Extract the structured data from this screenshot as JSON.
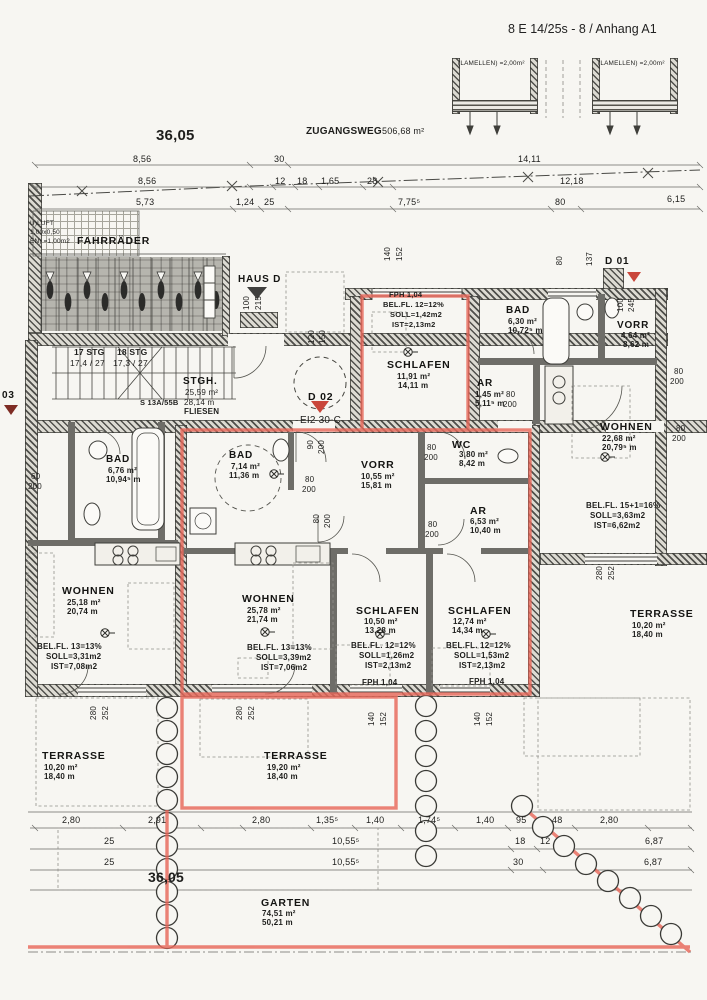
{
  "header": {
    "ref": "8 E 14/25s - 8 / Anhang A1"
  },
  "site": {
    "boundary_total_top": "36,05",
    "boundary_total_bottom": "36,05",
    "zugangsweg": "ZUGANGSWEG",
    "zugangsweg_area": "506,68 m²",
    "lamellen": "(LAMELLEN) =2,00m²",
    "luft1": "U)LUFT",
    "luft2": "1,00x0,50",
    "luft3": "EN) =1,00m2",
    "fahrraeder": "FAHRRÄDER",
    "haus_d": "HAUS D"
  },
  "stairwell": {
    "stg1": "17 STG",
    "stg1_rate": "17,4 / 27",
    "stg2": "18 STG",
    "stg2_rate": "17,3 / 27",
    "name": "STGH.",
    "area": "25,59 m²",
    "perimeter": "28,14 m",
    "floor": "FLIESEN",
    "section": "S 13A/55B"
  },
  "doors": {
    "d01": "D 01",
    "d02": "D 02",
    "d03": "03",
    "d02_class": "EI2 30-C"
  },
  "rooms": {
    "schlafen_top": {
      "name": "SCHLAFEN",
      "area": "11,91 m²",
      "perimeter": "14,11 m",
      "fph": "FPH 1,04",
      "bel": "BEL.FL. 12=12%",
      "soll": "SOLL=1,42m2",
      "ist": "IST=2,13m2"
    },
    "bad_right": {
      "name": "BAD",
      "area": "6,30 m²",
      "perimeter": "10,72⁵ m"
    },
    "vorr_right": {
      "name": "VORR",
      "area": "4,64 m²",
      "perimeter": "8,62 m"
    },
    "ar_small": {
      "name": "AR",
      "area": "1,45 m²",
      "perimeter": "5,11⁵ m"
    },
    "wohnen_right": {
      "name": "WOHNEN",
      "area": "22,68 m²",
      "perimeter": "20,79⁵ m",
      "bel": "BEL.FL. 15+1=16%",
      "soll": "SOLL=3,63m2",
      "ist": "IST=6,62m2"
    },
    "bad_left": {
      "name": "BAD",
      "area": "6,76 m²",
      "perimeter": "10,94⁵ m"
    },
    "wohnen_left": {
      "name": "WOHNEN",
      "area": "25,18 m²",
      "perimeter": "20,74 m",
      "bel": "BEL.FL. 13=13%",
      "soll": "SOLL=3,31m2",
      "ist": "IST=7,08m2"
    },
    "bad_mid": {
      "name": "BAD",
      "area": "7,14 m²",
      "perimeter": "11,36 m"
    },
    "vorr_mid": {
      "name": "VORR",
      "area": "10,55 m²",
      "perimeter": "15,81 m"
    },
    "wc": {
      "name": "WC",
      "area": "3,80 m²",
      "perimeter": "8,42 m"
    },
    "ar_mid": {
      "name": "AR",
      "area": "6,53 m²",
      "perimeter": "10,40 m"
    },
    "wohnen_mid": {
      "name": "WOHNEN",
      "area": "25,78 m²",
      "perimeter": "21,74 m",
      "bel": "BEL.FL. 13=13%",
      "soll": "SOLL=3,39m2",
      "ist": "IST=7,06m2"
    },
    "schlafen_left": {
      "name": "SCHLAFEN",
      "area": "10,50 m²",
      "perimeter": "13,28 m",
      "bel": "BEL.FL. 12=12%",
      "soll": "SOLL=1,26m2",
      "ist": "IST=2,13m2",
      "fph": "FPH 1,04"
    },
    "schlafen_right": {
      "name": "SCHLAFEN",
      "area": "12,74 m²",
      "perimeter": "14,34 m",
      "bel": "BEL.FL. 12=12%",
      "soll": "SOLL=1,53m2",
      "ist": "IST=2,13m2",
      "fph": "FPH 1,04"
    },
    "terrasse_left": {
      "name": "TERRASSE",
      "area": "10,20 m²",
      "perimeter": "18,40 m"
    },
    "terrasse_mid": {
      "name": "TERRASSE",
      "area": "19,20 m²",
      "perimeter": "18,40 m"
    },
    "terrasse_right": {
      "name": "TERRASSE",
      "area": "10,20 m²",
      "perimeter": "18,40 m"
    },
    "garten": {
      "name": "GARTEN",
      "area": "74,51 m²",
      "perimeter": "50,21 m"
    }
  },
  "dims_top": {
    "a1": "8,56",
    "a2": "30",
    "a3": "14,11",
    "b1": "8,56",
    "b2": "12",
    "b3": "18",
    "b4": "1,65",
    "b5": "28",
    "b6": "12,18",
    "c1": "5,73",
    "c2": "1,24",
    "c3": "25",
    "c4": "7,75⁵",
    "c5": "80",
    "c6": "6,15"
  },
  "dims_bottom": {
    "r1": [
      "2,80",
      "2,91",
      "2,80",
      "1,35⁵",
      "1,40",
      "1,74⁵",
      "1,40",
      "95",
      "48",
      "2,80"
    ],
    "r2": [
      "25",
      "10,55⁵",
      "18",
      "12",
      "6,87"
    ],
    "r3": [
      "25",
      "10,55⁵",
      "30",
      "6,87"
    ]
  },
  "dims_openings": {
    "d60": "60",
    "d80": "80",
    "d90": "90",
    "d100": "100",
    "d120": "120",
    "d137": "137",
    "d140": "140",
    "d150": "150",
    "d152": "152",
    "d200": "200",
    "d215": "215",
    "d245": "245",
    "d252": "252",
    "d280": "280"
  },
  "colors": {
    "highlight_red": "#e8685a",
    "paper": "#f7f6f2",
    "ink": "#3c3c38"
  }
}
